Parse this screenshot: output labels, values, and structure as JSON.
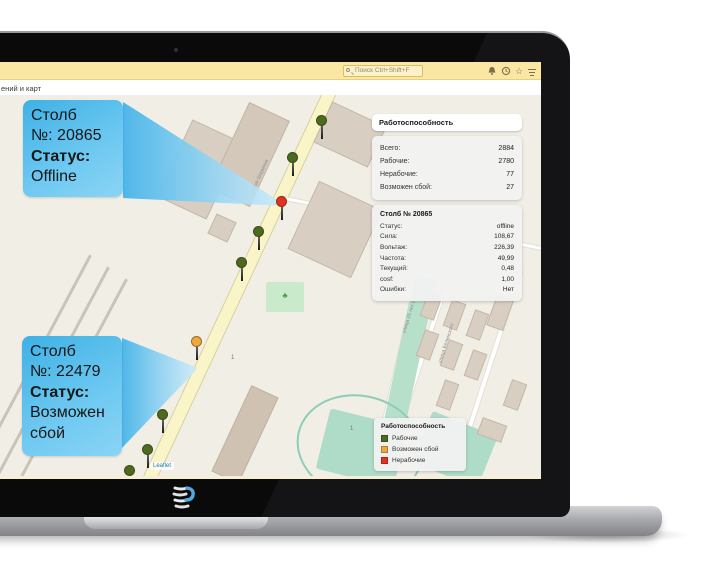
{
  "browser": {
    "search_placeholder": "Поиск Ctrl+Shift+F",
    "toolbar_icons": [
      "bell",
      "history",
      "star",
      "menu"
    ],
    "page_title_fragment": "ений и карт"
  },
  "callouts": [
    {
      "title": "Столб",
      "number": "№: 20865",
      "status_label": "Статус:",
      "status_value": "Offline"
    },
    {
      "title": "Столб",
      "number": "№: 22479",
      "status_label": "Статус:",
      "status_value": "Возможен сбой"
    }
  ],
  "stats_panel": {
    "title": "Работоспособность",
    "rows": [
      {
        "label": "Всего:",
        "value": "2884"
      },
      {
        "label": "Рабочие:",
        "value": "2780"
      },
      {
        "label": "Нерабочие:",
        "value": "77"
      },
      {
        "label": "Возможен сбой:",
        "value": "27"
      }
    ]
  },
  "detail_panel": {
    "title": "Столб № 20865",
    "rows": [
      {
        "label": "Статус:",
        "value": "offline"
      },
      {
        "label": "Сила:",
        "value": "108,67"
      },
      {
        "label": "Вольтаж:",
        "value": "226,39"
      },
      {
        "label": "Частота:",
        "value": "49,99"
      },
      {
        "label": "Текущий:",
        "value": "0,48"
      },
      {
        "label": "cosf:",
        "value": "1,00"
      },
      {
        "label": "Ошибки:",
        "value": "Нет"
      }
    ]
  },
  "legend_panel": {
    "title": "Работоспособность",
    "items": [
      {
        "label": "Рабочие",
        "color": "#4C6B1F"
      },
      {
        "label": "Возможен сбой",
        "color": "#F0A83E"
      },
      {
        "label": "Нерабочие",
        "color": "#E5321F"
      }
    ]
  },
  "map": {
    "attribution": "Leaflet",
    "street_labels": {
      "main": "улица Шаумяна",
      "right1": "улица 25 лет Октября",
      "right2": "улица Белинского"
    },
    "address_label": "1",
    "marker_colors": {
      "ok": "#4C6B1F",
      "warn": "#F0A83E",
      "fail": "#E5321F"
    },
    "markers": [
      {
        "x": 322,
        "y": 26,
        "status": "ok"
      },
      {
        "x": 293,
        "y": 63,
        "status": "ok"
      },
      {
        "x": 282,
        "y": 107,
        "status": "fail"
      },
      {
        "x": 259,
        "y": 137,
        "status": "ok"
      },
      {
        "x": 242,
        "y": 168,
        "status": "ok"
      },
      {
        "x": 197,
        "y": 247,
        "status": "warn"
      },
      {
        "x": 163,
        "y": 320,
        "status": "ok"
      },
      {
        "x": 148,
        "y": 355,
        "status": "ok"
      },
      {
        "x": 130,
        "y": 376,
        "status": "ok"
      }
    ]
  }
}
